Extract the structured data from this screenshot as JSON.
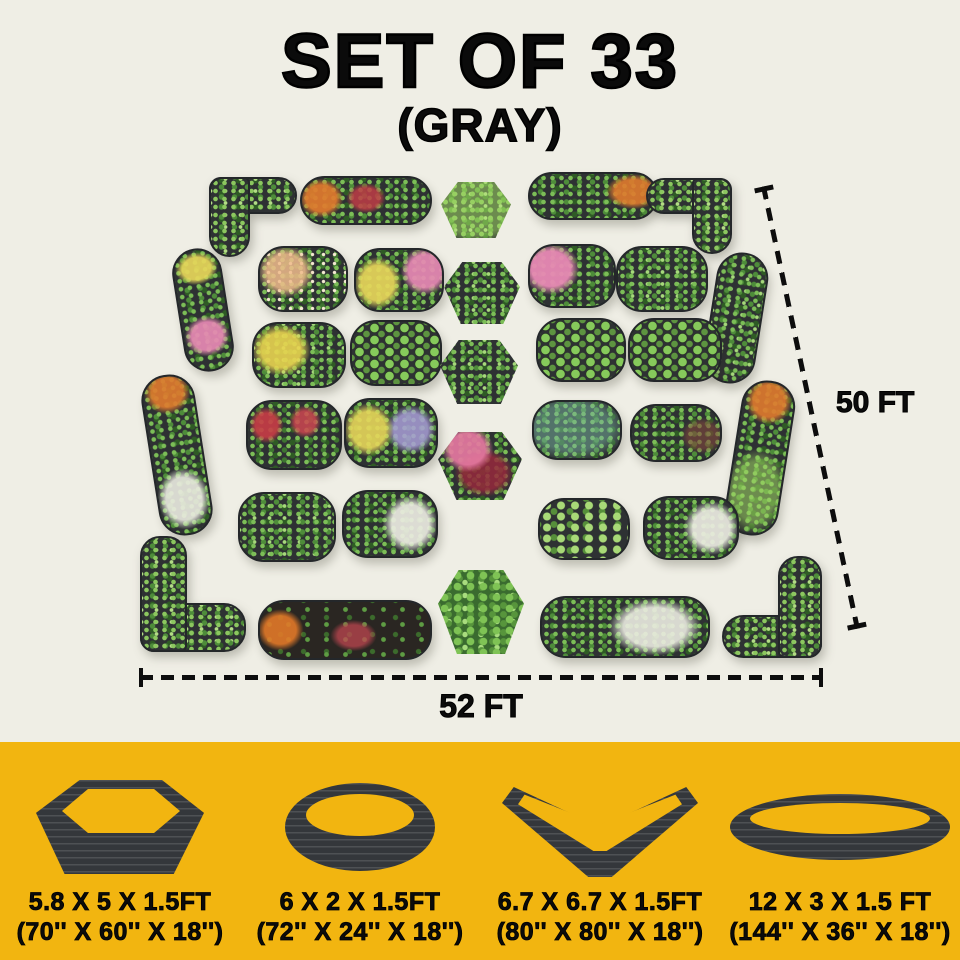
{
  "title": "SET OF 33",
  "subtitle": "(GRAY)",
  "plan": {
    "width_label": "52 FT",
    "height_label": "50 FT",
    "bed_count": 33,
    "beds": [
      {
        "name": "bed-corner-top-left",
        "type": "corner",
        "orient": "tl",
        "variant": "v-lime",
        "x": 209,
        "y": 177,
        "w": 84,
        "h": 76
      },
      {
        "name": "bed-long-top-left",
        "type": "oval",
        "variant": "v-redorange",
        "x": 300,
        "y": 176,
        "w": 128,
        "h": 45
      },
      {
        "name": "bed-hex-top",
        "type": "hex",
        "variant": "v-lime",
        "x": 441,
        "y": 182,
        "w": 70,
        "h": 56
      },
      {
        "name": "bed-long-top-right",
        "type": "oval",
        "variant": "v-orange",
        "x": 528,
        "y": 172,
        "w": 126,
        "h": 44
      },
      {
        "name": "bed-corner-top-right",
        "type": "corner",
        "orient": "tr",
        "variant": "v-green",
        "x": 650,
        "y": 178,
        "w": 82,
        "h": 72
      },
      {
        "name": "bed-left-upper",
        "type": "oval",
        "variant": "v-mixed",
        "x": 178,
        "y": 248,
        "w": 46,
        "h": 120,
        "rot": -9
      },
      {
        "name": "bed-left-lower",
        "type": "oval",
        "variant": "v-whiteorange",
        "x": 150,
        "y": 374,
        "w": 50,
        "h": 158,
        "rot": -9
      },
      {
        "name": "bed-right-upper",
        "type": "oval",
        "variant": "v-green",
        "x": 710,
        "y": 252,
        "w": 48,
        "h": 128,
        "rot": 9
      },
      {
        "name": "bed-right-lower",
        "type": "oval",
        "variant": "v-orangelime",
        "x": 733,
        "y": 380,
        "w": 50,
        "h": 152,
        "rot": 9
      },
      {
        "name": "bed-row2-col1",
        "type": "oval",
        "variant": "v-peach",
        "x": 258,
        "y": 246,
        "w": 86,
        "h": 62
      },
      {
        "name": "bed-row2-col2",
        "type": "oval",
        "variant": "v-yellowpink",
        "x": 354,
        "y": 248,
        "w": 86,
        "h": 60
      },
      {
        "name": "bed-hex-2",
        "type": "hex",
        "variant": "v-green",
        "x": 444,
        "y": 262,
        "w": 76,
        "h": 62
      },
      {
        "name": "bed-row2-col3",
        "type": "oval",
        "variant": "v-pink",
        "x": 528,
        "y": 244,
        "w": 84,
        "h": 60
      },
      {
        "name": "bed-row2-col4",
        "type": "oval",
        "variant": "v-green",
        "x": 616,
        "y": 246,
        "w": 88,
        "h": 62
      },
      {
        "name": "bed-row3-col1",
        "type": "oval",
        "variant": "v-yellow",
        "x": 252,
        "y": 322,
        "w": 90,
        "h": 62
      },
      {
        "name": "bed-row3-col2",
        "type": "oval",
        "variant": "v-rows",
        "x": 350,
        "y": 320,
        "w": 88,
        "h": 62
      },
      {
        "name": "bed-hex-3",
        "type": "hex",
        "variant": "v-green",
        "x": 440,
        "y": 340,
        "w": 78,
        "h": 64
      },
      {
        "name": "bed-row3-col3",
        "type": "oval",
        "variant": "v-rows",
        "x": 536,
        "y": 318,
        "w": 86,
        "h": 60
      },
      {
        "name": "bed-row3-col4",
        "type": "oval",
        "variant": "v-rows",
        "x": 628,
        "y": 318,
        "w": 90,
        "h": 60
      },
      {
        "name": "bed-row4-col1",
        "type": "oval",
        "variant": "v-red",
        "x": 246,
        "y": 400,
        "w": 92,
        "h": 66
      },
      {
        "name": "bed-row4-col2",
        "type": "oval",
        "variant": "v-yellowpurple",
        "x": 344,
        "y": 398,
        "w": 90,
        "h": 66
      },
      {
        "name": "bed-hex-4",
        "type": "hex",
        "variant": "v-pinkred",
        "x": 438,
        "y": 432,
        "w": 84,
        "h": 68
      },
      {
        "name": "bed-row4-col3",
        "type": "oval",
        "variant": "v-teal",
        "x": 532,
        "y": 400,
        "w": 86,
        "h": 56
      },
      {
        "name": "bed-row4-col4",
        "type": "oval",
        "variant": "v-green2",
        "x": 630,
        "y": 404,
        "w": 88,
        "h": 54
      },
      {
        "name": "bed-row5-col1",
        "type": "oval",
        "variant": "v-green",
        "x": 238,
        "y": 492,
        "w": 94,
        "h": 66
      },
      {
        "name": "bed-row5-col2",
        "type": "oval",
        "variant": "v-white",
        "x": 342,
        "y": 490,
        "w": 92,
        "h": 64
      },
      {
        "name": "bed-row5-col3",
        "type": "oval",
        "variant": "v-limegreen",
        "x": 538,
        "y": 498,
        "w": 88,
        "h": 58
      },
      {
        "name": "bed-row5-col4",
        "type": "oval",
        "variant": "v-white",
        "x": 643,
        "y": 496,
        "w": 92,
        "h": 60
      },
      {
        "name": "bed-corner-bottom-left",
        "type": "corner",
        "orient": "bl",
        "variant": "v-lime",
        "x": 140,
        "y": 540,
        "w": 102,
        "h": 112
      },
      {
        "name": "bed-long-bottom-left",
        "type": "oval",
        "variant": "v-soil",
        "x": 258,
        "y": 600,
        "w": 170,
        "h": 56
      },
      {
        "name": "bed-hex-bottom",
        "type": "hex",
        "variant": "v-bush",
        "x": 438,
        "y": 570,
        "w": 86,
        "h": 84
      },
      {
        "name": "bed-long-bottom-right",
        "type": "oval",
        "variant": "v-whitegreen",
        "x": 540,
        "y": 596,
        "w": 166,
        "h": 58
      },
      {
        "name": "bed-corner-bottom-right",
        "type": "corner",
        "orient": "br",
        "variant": "v-lime",
        "x": 726,
        "y": 560,
        "w": 96,
        "h": 98
      }
    ]
  },
  "legend": {
    "items": [
      {
        "shape": "hexagonal-bed",
        "size_ft": "5.8 X 5 X 1.5FT",
        "size_in": "(70'' X 60'' X 18'')"
      },
      {
        "shape": "oval-bed",
        "size_ft": "6 X 2 X 1.5FT",
        "size_in": "(72'' X 24'' X 18'')"
      },
      {
        "shape": "v-shaped-bed",
        "size_ft": "6.7 X 6.7 X 1.5FT",
        "size_in": "(80'' X 80'' X 18'')"
      },
      {
        "shape": "long-oval-bed",
        "size_ft": "12 X 3 X 1.5 FT",
        "size_in": "(144'' X 36'' X 18'')"
      }
    ]
  },
  "colors": {
    "page_bg": "#EFEEE5",
    "band_bg": "#F2B510",
    "bed_frame": "#2E3133",
    "text": "#0B0B0B"
  }
}
